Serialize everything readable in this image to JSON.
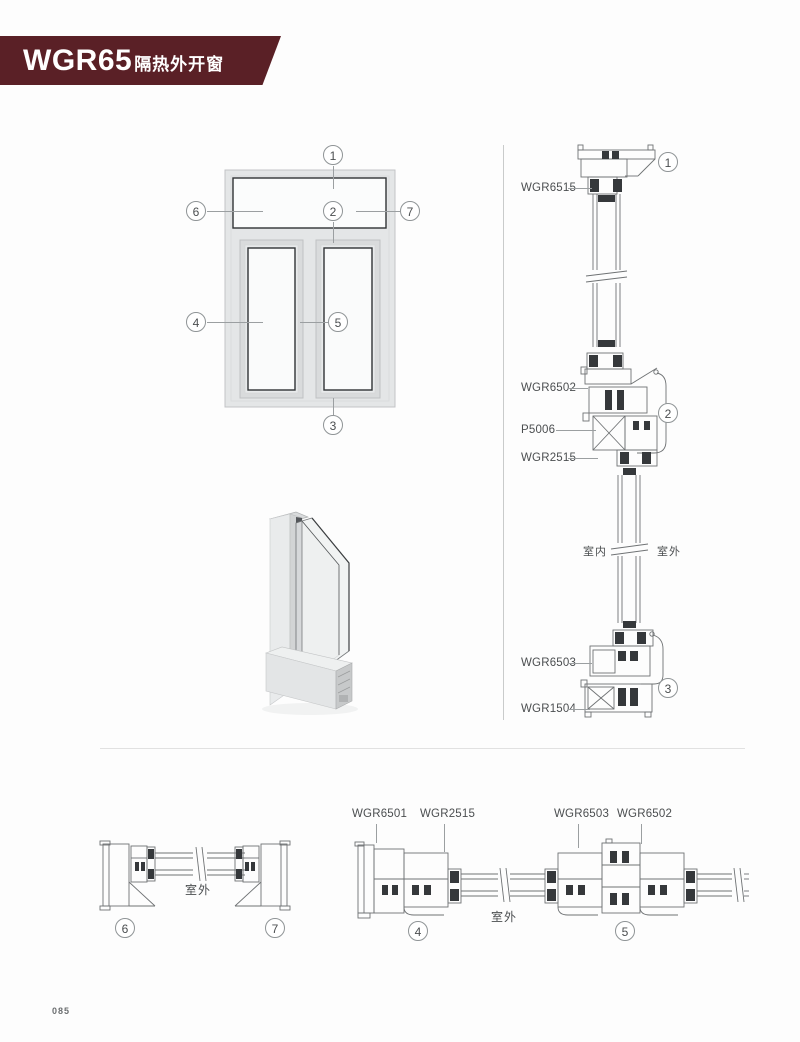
{
  "banner": {
    "model": "WGR65",
    "subtitle": "隔热外开窗",
    "bg_color": "#5a2026",
    "text_color": "#ffffff"
  },
  "elevation": {
    "callouts": [
      {
        "id": "1"
      },
      {
        "id": "2"
      },
      {
        "id": "3"
      },
      {
        "id": "4"
      },
      {
        "id": "5"
      },
      {
        "id": "6"
      },
      {
        "id": "7"
      }
    ]
  },
  "vertical_section": {
    "labels": [
      {
        "text": "WGR6515"
      },
      {
        "text": "WGR6502"
      },
      {
        "text": "P5006"
      },
      {
        "text": "WGR2515"
      },
      {
        "text": "WGR6503"
      },
      {
        "text": "WGR1504"
      }
    ],
    "callouts": [
      {
        "id": "1"
      },
      {
        "id": "2"
      },
      {
        "id": "3"
      }
    ],
    "indoor_label": "室内",
    "outdoor_label": "室外"
  },
  "bottom_left_section": {
    "outdoor_label": "室外",
    "callouts": [
      {
        "id": "6"
      },
      {
        "id": "7"
      }
    ]
  },
  "bottom_right_section": {
    "labels": [
      {
        "text": "WGR6501"
      },
      {
        "text": "WGR2515"
      },
      {
        "text": "WGR6503"
      },
      {
        "text": "WGR6502"
      }
    ],
    "outdoor_label": "室外",
    "callouts": [
      {
        "id": "4"
      },
      {
        "id": "5"
      }
    ]
  },
  "page": {
    "number": "085"
  }
}
